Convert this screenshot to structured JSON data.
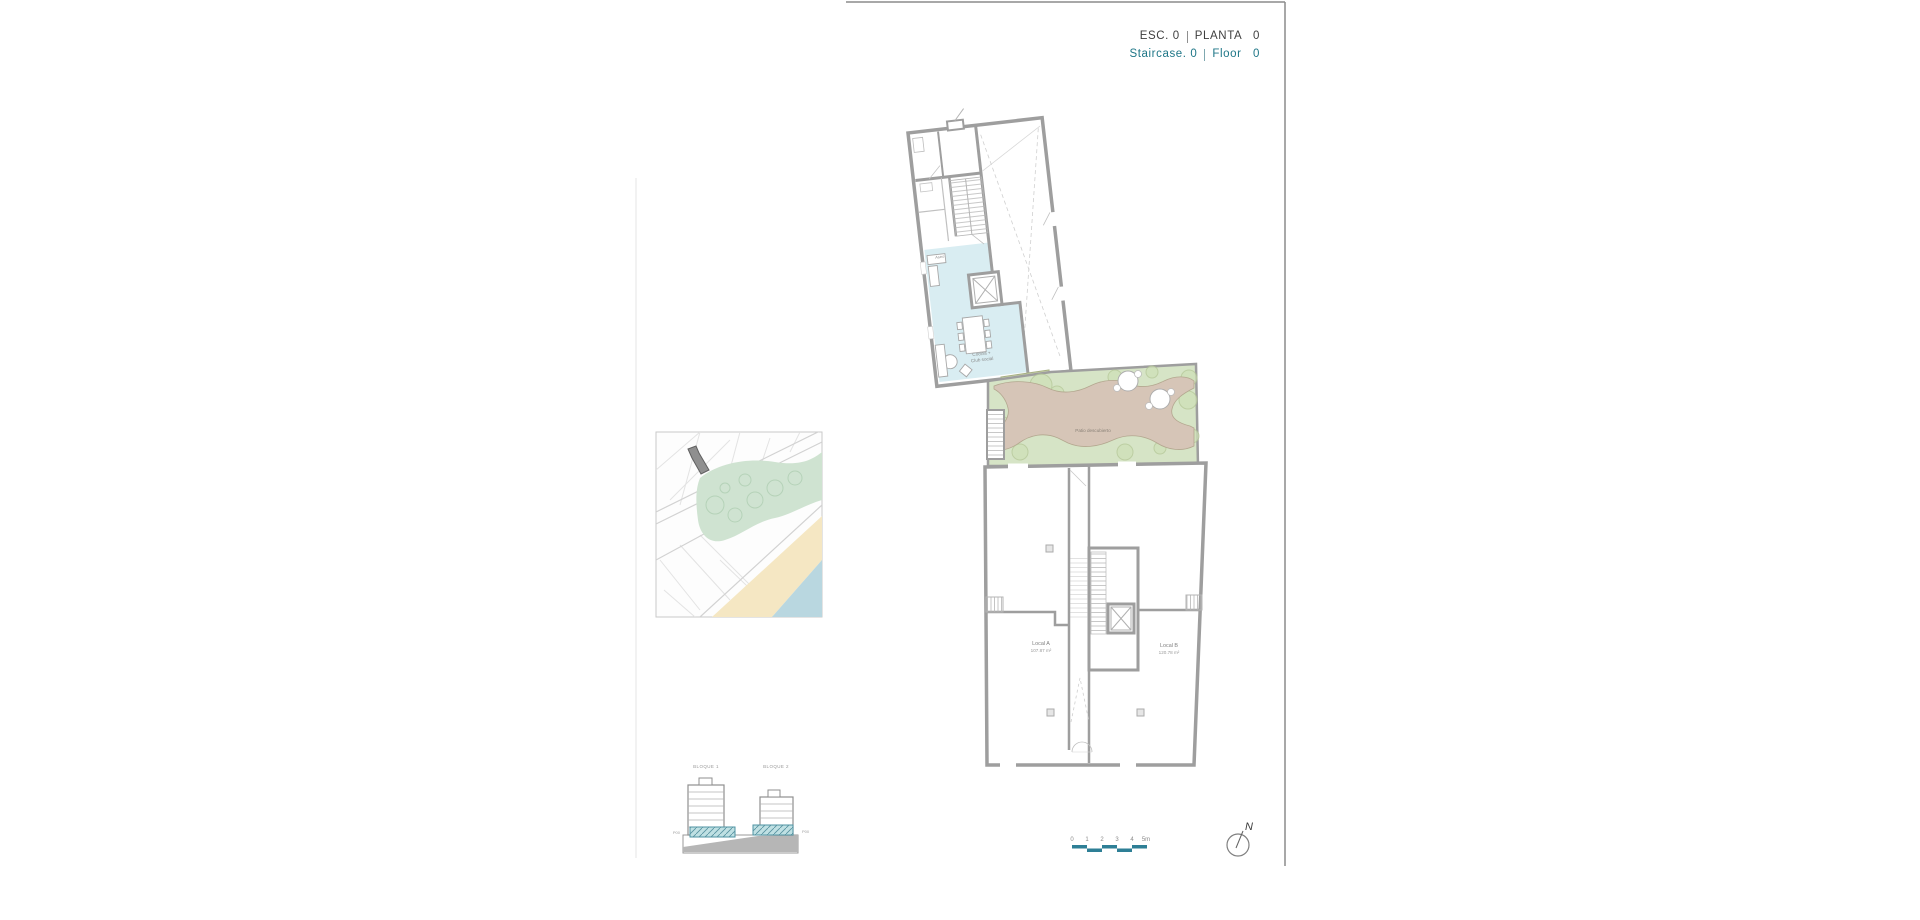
{
  "title_block": {
    "esc": "ESC. 0",
    "planta": "PLANTA   0",
    "staircase": "Staircase. 0",
    "floor": "Floor   0"
  },
  "floor_plan": {
    "labels": {
      "aseo": "Aseo",
      "cocina_line1": "Cocina +",
      "cocina_line2": "Club social",
      "patio_cubierto": "Patio cubierto",
      "patio_descubierto": "Patio descubierto",
      "local_a_name": "Local A",
      "local_a_area": "107.87 m²",
      "local_b_name": "Local B",
      "local_b_area": "120.78 m²"
    }
  },
  "elevation": {
    "bloque1": "BLOQUE 1",
    "bloque2": "BLOQUE 2",
    "level_left": "P00",
    "level_right": "P00"
  },
  "scale_bar": {
    "ticks": [
      "0",
      "1",
      "2",
      "3",
      "4",
      "5m"
    ]
  },
  "compass": {
    "north": "N"
  },
  "colors": {
    "accent_teal": "#1e7687",
    "scalebar_teal": "#2e7f96",
    "plan_blue": "#d9edf2",
    "plan_green": "#d6e4c6",
    "plan_paving_brown": "#d6c5b7",
    "covered_patio_green": "#cfd9b0",
    "map_park": "#cfe3d1",
    "map_sand": "#f5e7c3",
    "map_sea": "#b9d7e0",
    "map_highlight_building": "#8f8f8f",
    "elevation_floor_teal": "#bfe0e3"
  }
}
